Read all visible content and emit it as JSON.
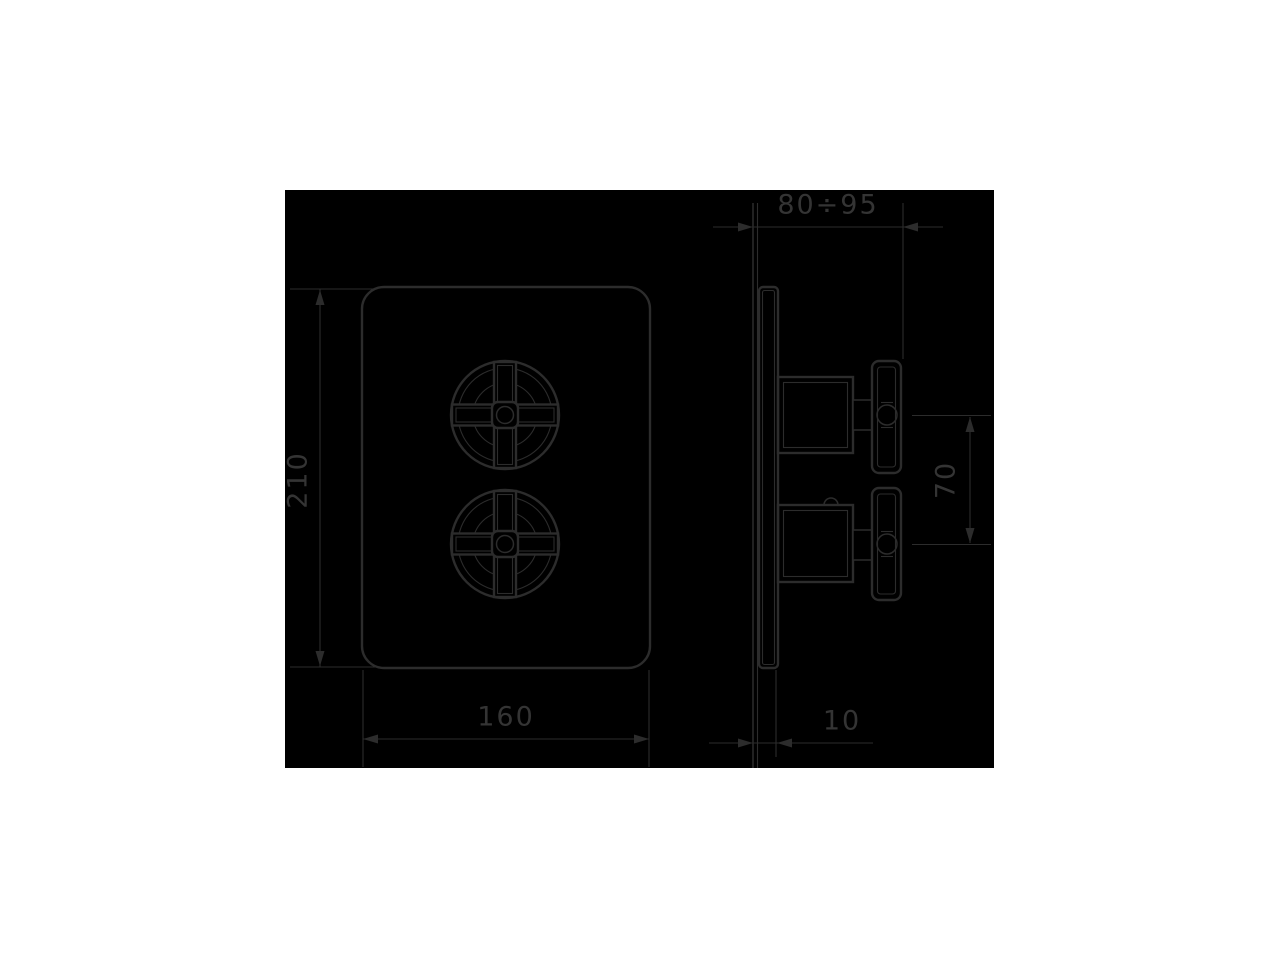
{
  "drawing": {
    "dimensions": {
      "plate_height": "210",
      "plate_width": "160",
      "installation_depth_range": "80÷95",
      "handle_center_distance": "70",
      "plate_thickness": "10"
    },
    "colors": {
      "page_background": "#ffffff",
      "drawing_background": "#000000",
      "line_color": "#2c2c2c",
      "text_color": "#343434"
    }
  }
}
